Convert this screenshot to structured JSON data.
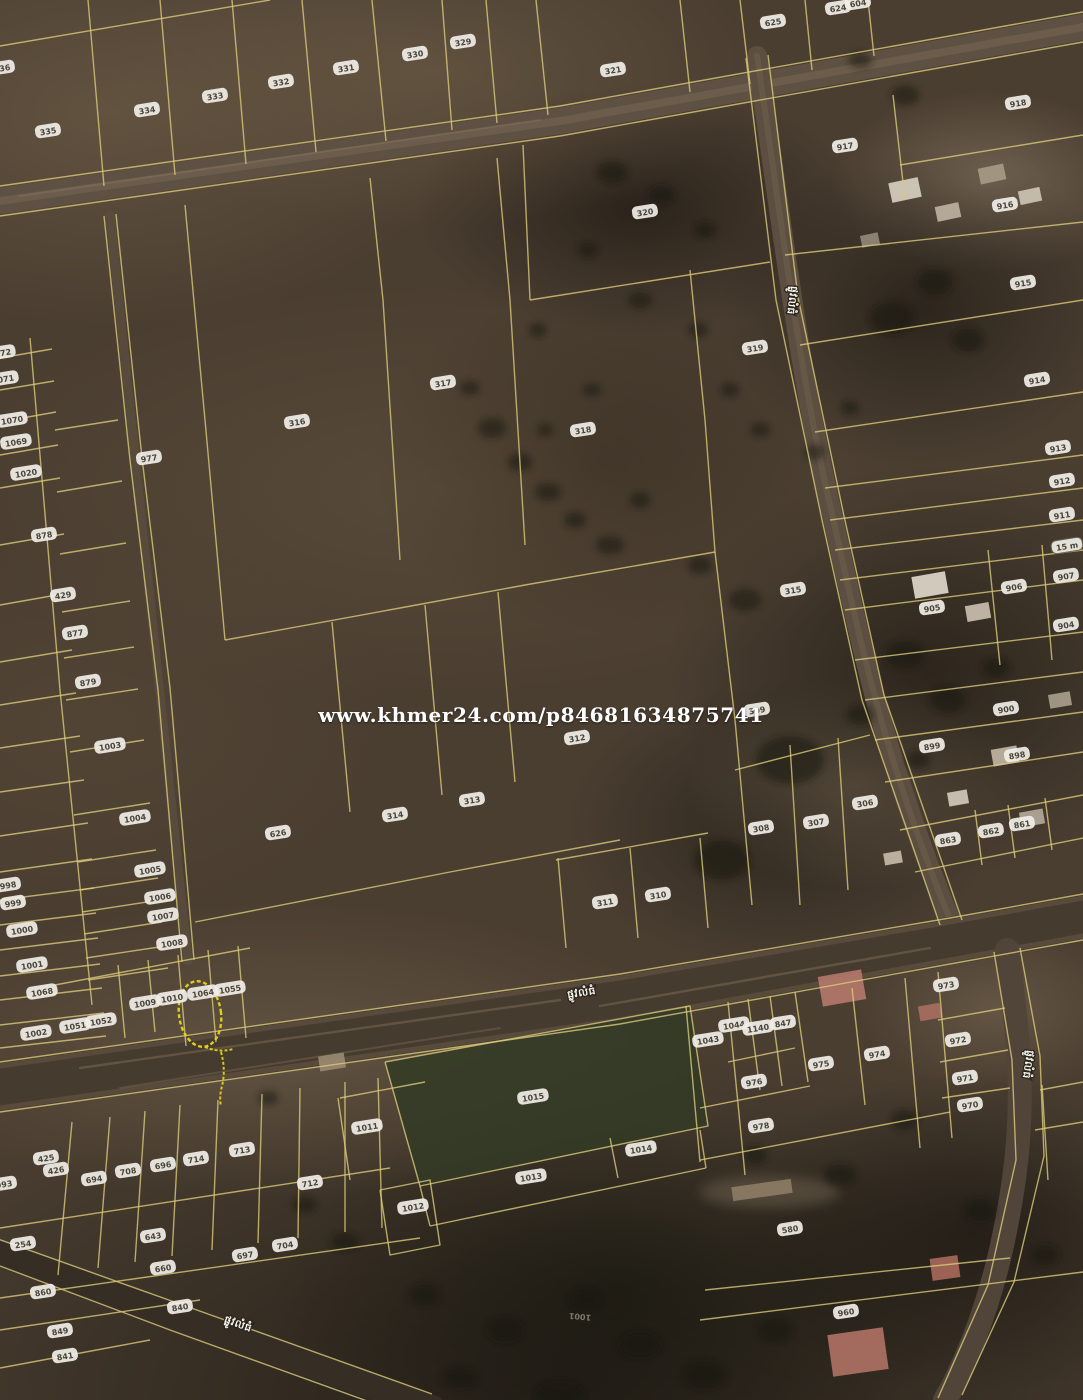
{
  "watermark": {
    "text": "www.khmer24.com/p84681634875741"
  },
  "map": {
    "colors": {
      "boundary": "#d9c979",
      "label_bg": "#f1eee8",
      "label_text": "#4a4438",
      "road_label_text": "#f5f2ea",
      "watermark": "#ffffff",
      "highlight": "#e8d41c"
    },
    "parcel_labels": [
      {
        "t": "336",
        "x": 2,
        "y": 68
      },
      {
        "t": "335",
        "x": 48,
        "y": 131
      },
      {
        "t": "334",
        "x": 147,
        "y": 110
      },
      {
        "t": "333",
        "x": 215,
        "y": 96
      },
      {
        "t": "332",
        "x": 281,
        "y": 82
      },
      {
        "t": "331",
        "x": 346,
        "y": 68
      },
      {
        "t": "330",
        "x": 415,
        "y": 54
      },
      {
        "t": "329",
        "x": 463,
        "y": 42
      },
      {
        "t": "321",
        "x": 613,
        "y": 70
      },
      {
        "t": "625",
        "x": 773,
        "y": 22
      },
      {
        "t": "624",
        "x": 838,
        "y": 8
      },
      {
        "t": "604",
        "x": 858,
        "y": 3
      },
      {
        "t": "918",
        "x": 1018,
        "y": 103
      },
      {
        "t": "917",
        "x": 845,
        "y": 146
      },
      {
        "t": "916",
        "x": 1005,
        "y": 205
      },
      {
        "t": "915",
        "x": 1023,
        "y": 283
      },
      {
        "t": "914",
        "x": 1037,
        "y": 380
      },
      {
        "t": "913",
        "x": 1058,
        "y": 448
      },
      {
        "t": "912",
        "x": 1062,
        "y": 481
      },
      {
        "t": "911",
        "x": 1062,
        "y": 515
      },
      {
        "t": "907",
        "x": 1066,
        "y": 576
      },
      {
        "t": "906",
        "x": 1014,
        "y": 587
      },
      {
        "t": "905",
        "x": 932,
        "y": 608
      },
      {
        "t": "904",
        "x": 1066,
        "y": 625
      },
      {
        "t": "900",
        "x": 1006,
        "y": 709
      },
      {
        "t": "899",
        "x": 932,
        "y": 746
      },
      {
        "t": "898",
        "x": 1017,
        "y": 755
      },
      {
        "t": "863",
        "x": 948,
        "y": 840
      },
      {
        "t": "862",
        "x": 991,
        "y": 831
      },
      {
        "t": "861",
        "x": 1022,
        "y": 824
      },
      {
        "t": "320",
        "x": 645,
        "y": 212
      },
      {
        "t": "319",
        "x": 755,
        "y": 348
      },
      {
        "t": "318",
        "x": 583,
        "y": 430
      },
      {
        "t": "317",
        "x": 443,
        "y": 383
      },
      {
        "t": "316",
        "x": 297,
        "y": 422
      },
      {
        "t": "977",
        "x": 149,
        "y": 458
      },
      {
        "t": "315",
        "x": 793,
        "y": 590
      },
      {
        "t": "312",
        "x": 577,
        "y": 738
      },
      {
        "t": "313",
        "x": 472,
        "y": 800
      },
      {
        "t": "314",
        "x": 395,
        "y": 815
      },
      {
        "t": "626",
        "x": 278,
        "y": 833
      },
      {
        "t": "309",
        "x": 757,
        "y": 710
      },
      {
        "t": "308",
        "x": 761,
        "y": 828
      },
      {
        "t": "307",
        "x": 816,
        "y": 822
      },
      {
        "t": "306",
        "x": 865,
        "y": 803
      },
      {
        "t": "311",
        "x": 605,
        "y": 902
      },
      {
        "t": "310",
        "x": 658,
        "y": 895
      },
      {
        "t": "1072",
        "x": 0,
        "y": 353
      },
      {
        "t": "1071",
        "x": 3,
        "y": 379
      },
      {
        "t": "1070",
        "x": 12,
        "y": 420
      },
      {
        "t": "1069",
        "x": 16,
        "y": 442
      },
      {
        "t": "1020",
        "x": 26,
        "y": 473
      },
      {
        "t": "878",
        "x": 44,
        "y": 535
      },
      {
        "t": "429",
        "x": 63,
        "y": 595
      },
      {
        "t": "877",
        "x": 75,
        "y": 633
      },
      {
        "t": "879",
        "x": 88,
        "y": 682
      },
      {
        "t": "1003",
        "x": 110,
        "y": 746
      },
      {
        "t": "1004",
        "x": 135,
        "y": 818
      },
      {
        "t": "1005",
        "x": 150,
        "y": 870
      },
      {
        "t": "1006",
        "x": 160,
        "y": 897
      },
      {
        "t": "1007",
        "x": 163,
        "y": 916
      },
      {
        "t": "1008",
        "x": 172,
        "y": 943
      },
      {
        "t": "998",
        "x": 8,
        "y": 885
      },
      {
        "t": "999",
        "x": 13,
        "y": 903
      },
      {
        "t": "1000",
        "x": 22,
        "y": 930
      },
      {
        "t": "1001",
        "x": 32,
        "y": 965
      },
      {
        "t": "1068",
        "x": 42,
        "y": 992
      },
      {
        "t": "1002",
        "x": 36,
        "y": 1033
      },
      {
        "t": "1051",
        "x": 75,
        "y": 1026
      },
      {
        "t": "1052",
        "x": 101,
        "y": 1021
      },
      {
        "t": "1009",
        "x": 145,
        "y": 1003
      },
      {
        "t": "1010",
        "x": 172,
        "y": 998
      },
      {
        "t": "1064",
        "x": 203,
        "y": 993
      },
      {
        "t": "1055",
        "x": 230,
        "y": 989
      },
      {
        "t": "425",
        "x": 46,
        "y": 1158
      },
      {
        "t": "426",
        "x": 56,
        "y": 1170
      },
      {
        "t": "993",
        "x": 4,
        "y": 1184
      },
      {
        "t": "694",
        "x": 94,
        "y": 1179
      },
      {
        "t": "708",
        "x": 128,
        "y": 1171
      },
      {
        "t": "696",
        "x": 163,
        "y": 1165
      },
      {
        "t": "714",
        "x": 196,
        "y": 1159
      },
      {
        "t": "713",
        "x": 242,
        "y": 1150
      },
      {
        "t": "712",
        "x": 310,
        "y": 1183
      },
      {
        "t": "254",
        "x": 23,
        "y": 1244
      },
      {
        "t": "643",
        "x": 153,
        "y": 1236
      },
      {
        "t": "660",
        "x": 163,
        "y": 1268
      },
      {
        "t": "697",
        "x": 245,
        "y": 1255
      },
      {
        "t": "704",
        "x": 285,
        "y": 1245
      },
      {
        "t": "860",
        "x": 43,
        "y": 1292
      },
      {
        "t": "849",
        "x": 60,
        "y": 1331
      },
      {
        "t": "841",
        "x": 65,
        "y": 1356
      },
      {
        "t": "840",
        "x": 180,
        "y": 1307
      },
      {
        "t": "1011",
        "x": 367,
        "y": 1127
      },
      {
        "t": "1015",
        "x": 533,
        "y": 1097
      },
      {
        "t": "1014",
        "x": 641,
        "y": 1149
      },
      {
        "t": "1013",
        "x": 531,
        "y": 1177
      },
      {
        "t": "1012",
        "x": 413,
        "y": 1207
      },
      {
        "t": "1043",
        "x": 708,
        "y": 1040
      },
      {
        "t": "1044",
        "x": 734,
        "y": 1025
      },
      {
        "t": "1140",
        "x": 758,
        "y": 1028
      },
      {
        "t": "847",
        "x": 783,
        "y": 1023
      },
      {
        "t": "976",
        "x": 754,
        "y": 1082
      },
      {
        "t": "978",
        "x": 761,
        "y": 1126
      },
      {
        "t": "975",
        "x": 821,
        "y": 1064
      },
      {
        "t": "974",
        "x": 877,
        "y": 1054
      },
      {
        "t": "973",
        "x": 946,
        "y": 985
      },
      {
        "t": "972",
        "x": 958,
        "y": 1040
      },
      {
        "t": "971",
        "x": 965,
        "y": 1078
      },
      {
        "t": "970",
        "x": 970,
        "y": 1105
      },
      {
        "t": "580",
        "x": 790,
        "y": 1229
      },
      {
        "t": "960",
        "x": 846,
        "y": 1312
      },
      {
        "t": "15 m",
        "x": 1067,
        "y": 546,
        "box": true
      },
      {
        "t": "1001",
        "x": 580,
        "y": 1317,
        "faint": true,
        "rot": 185
      }
    ],
    "road_name_labels": [
      {
        "t": "ផ្លូវលំធំ",
        "x": 789,
        "y": 300,
        "rot": 97
      },
      {
        "t": "ផ្លូវលំធំ",
        "x": 582,
        "y": 996,
        "rot": -9
      },
      {
        "t": "ផ្លូវលំធំ",
        "x": 1025,
        "y": 1064,
        "rot": 99
      },
      {
        "t": "ផ្លូវលំធំ",
        "x": 237,
        "y": 1327,
        "rot": 20
      }
    ],
    "highlight": {
      "cx": 200,
      "cy": 1014,
      "rx": 21,
      "ry": 33,
      "rot": -8,
      "squiggle": "M205,1047 q14,6 28,2 M221,1052 q5,18 1,34 q-3,12 -1,20"
    }
  }
}
